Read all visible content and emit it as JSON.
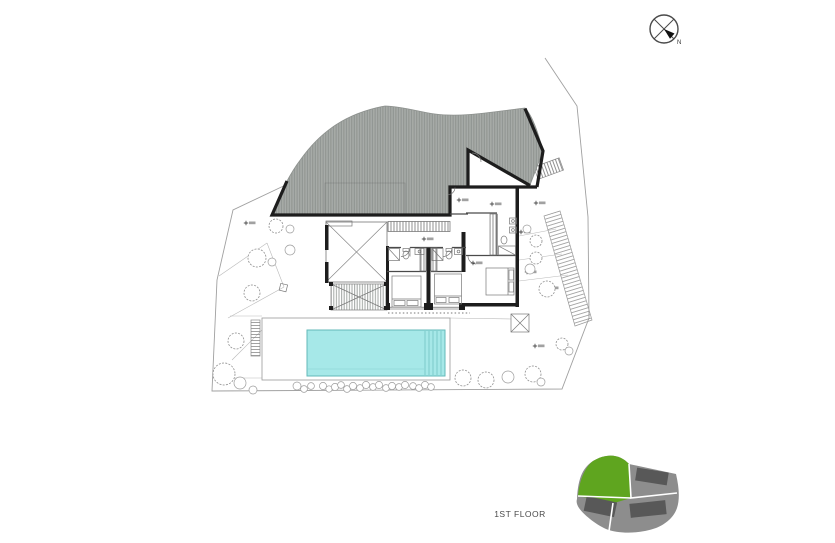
{
  "title": {
    "floor_label": "1ST FLOOR"
  },
  "compass": {
    "label": "N"
  },
  "colors": {
    "roof_base": "#a7aba8",
    "roof_stripe": "#8e938f",
    "wall": "#1d1d1d",
    "pool_water": "#a6e8e8",
    "pool_edge": "#63b9b9",
    "site_parcel_green": "#5fa51f",
    "site_parcel_gray": "#8d8d8d",
    "site_footprint_dark": "#585858",
    "boundary_gray": "#a0a0a0"
  }
}
